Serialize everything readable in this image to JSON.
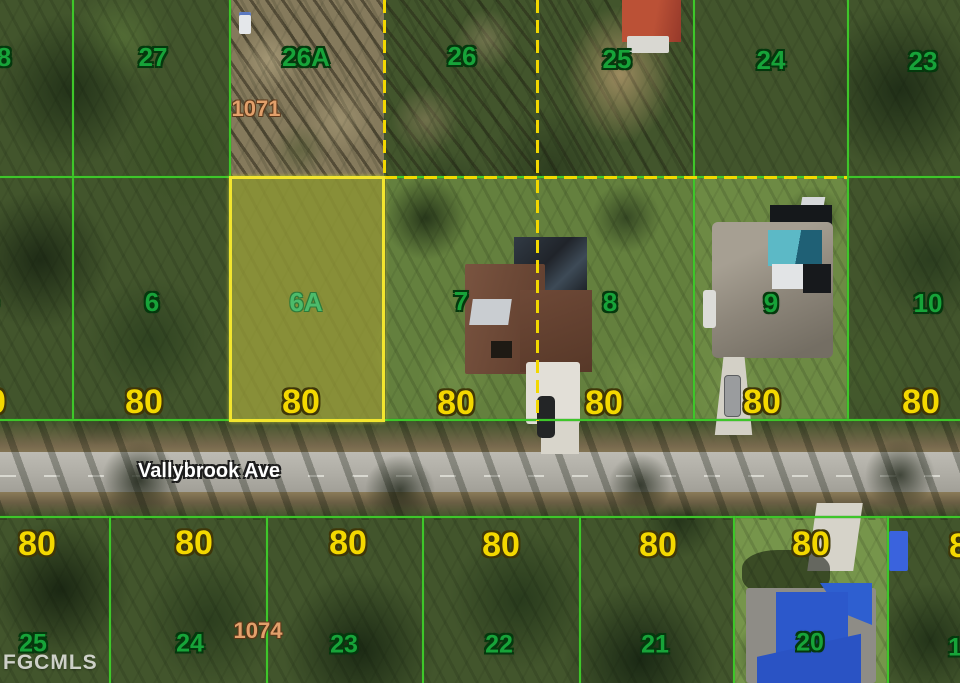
{
  "map": {
    "type": "aerial-parcel-map",
    "street": {
      "name": "Vallybrook Ave"
    },
    "watermark": "FGCMLS",
    "highlighted_lot": "6A",
    "colors": {
      "lot_line_green": "#3ec62a",
      "boundary_dash_yellow": "#f2d800",
      "lot_number_green": "#17a339",
      "dimension_yellow": "#f4d800",
      "parcel_id_tan": "#e2a06b",
      "highlight_fill": "rgba(222,214,70,0.45)",
      "road_gray": "#aeaca4"
    }
  },
  "top_row": {
    "lot_labels": [
      "8",
      "27",
      "26A",
      "26",
      "25",
      "24",
      "23"
    ],
    "parcel_id": "1071"
  },
  "middle_row": {
    "lot_labels": [
      "5",
      "6",
      "6A",
      "7",
      "8",
      "9",
      "10"
    ],
    "dimension_labels": [
      "80",
      "80",
      "80",
      "80",
      "80",
      "80",
      "80"
    ]
  },
  "bottom_row": {
    "lot_labels": [
      "25",
      "24",
      "23",
      "22",
      "21",
      "20",
      "19"
    ],
    "dimension_labels": [
      "80",
      "80",
      "80",
      "80",
      "80",
      "80",
      "80"
    ],
    "parcel_id": "1074"
  }
}
